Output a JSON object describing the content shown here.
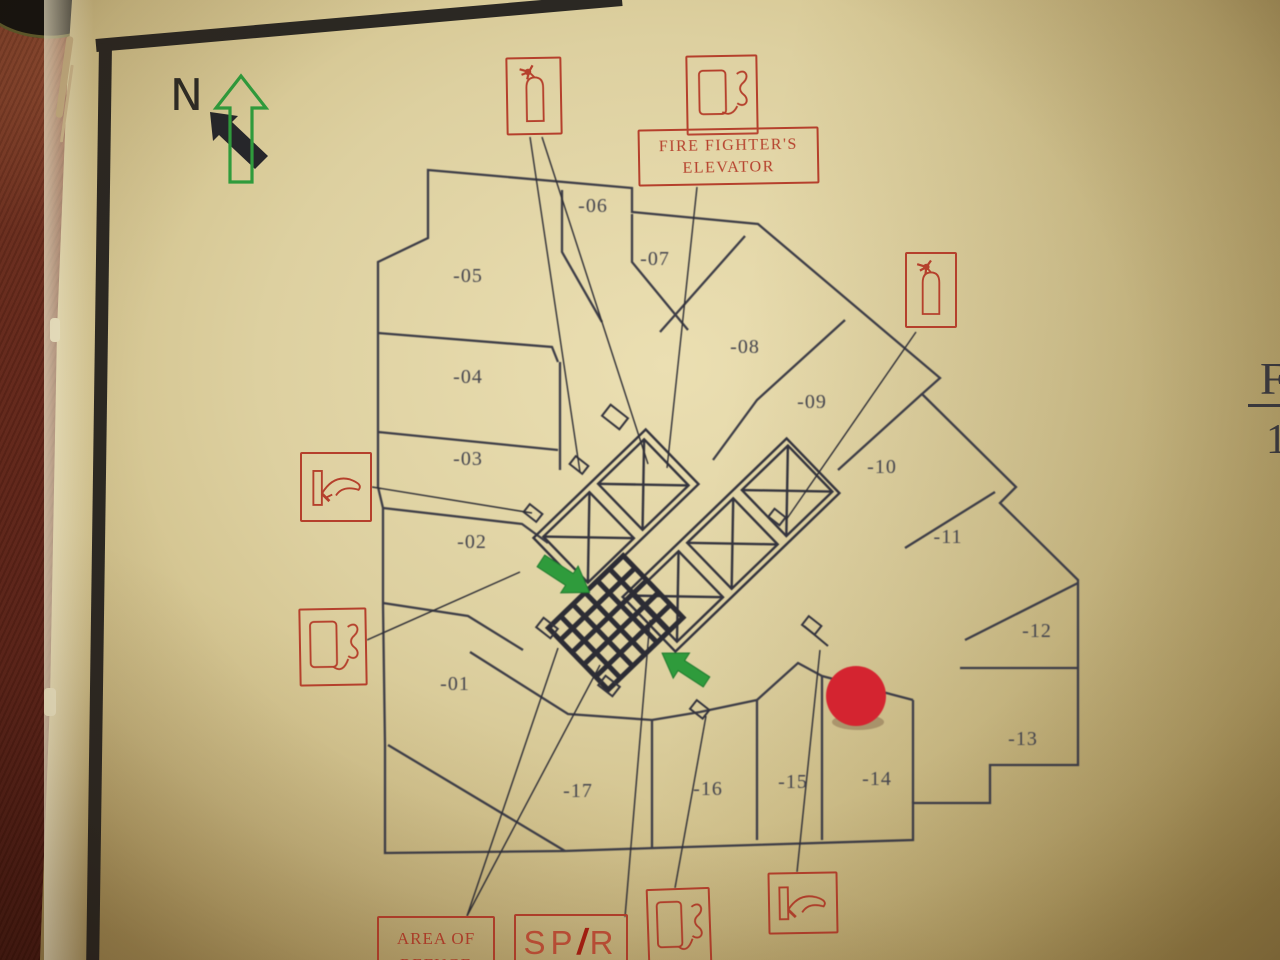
{
  "compass": {
    "north_label": "N"
  },
  "floor_plan": {
    "rooms": [
      {
        "label": "-01",
        "x": 455,
        "y": 690
      },
      {
        "label": "-02",
        "x": 472,
        "y": 548
      },
      {
        "label": "-03",
        "x": 468,
        "y": 465
      },
      {
        "label": "-04",
        "x": 468,
        "y": 383
      },
      {
        "label": "-05",
        "x": 468,
        "y": 282
      },
      {
        "label": "-06",
        "x": 593,
        "y": 212
      },
      {
        "label": "-07",
        "x": 655,
        "y": 265
      },
      {
        "label": "-08",
        "x": 745,
        "y": 353
      },
      {
        "label": "-09",
        "x": 812,
        "y": 408
      },
      {
        "label": "-10",
        "x": 882,
        "y": 473
      },
      {
        "label": "-11",
        "x": 948,
        "y": 543
      },
      {
        "label": "-12",
        "x": 1037,
        "y": 637
      },
      {
        "label": "-13",
        "x": 1023,
        "y": 745
      },
      {
        "label": "-14",
        "x": 877,
        "y": 785
      },
      {
        "label": "-15",
        "x": 793,
        "y": 788
      },
      {
        "label": "-16",
        "x": 708,
        "y": 795
      },
      {
        "label": "-17",
        "x": 578,
        "y": 797
      }
    ],
    "annotations": {
      "fire_fighters_elevator_line1": "FIRE FIGHTER'S",
      "fire_fighters_elevator_line2": "ELEVATOR",
      "area_of_refuge_line1": "AREA OF",
      "area_of_refuge_line2": "REFUGE",
      "spr_sp": "SP",
      "spr_slash": "/",
      "spr_r": "R"
    },
    "symbols": [
      {
        "icon": "fire-extinguisher",
        "count": 2
      },
      {
        "icon": "telephone",
        "count": 3
      },
      {
        "icon": "fire-hose-reel",
        "count": 2
      }
    ],
    "you_are_here_color": "#d42430",
    "exit_arrow_color": "#2f9b3c",
    "wall_color": "#3d3d47",
    "symbol_color": "#b5402c"
  },
  "edge_heading": {
    "top": "F",
    "bottom": "1"
  }
}
